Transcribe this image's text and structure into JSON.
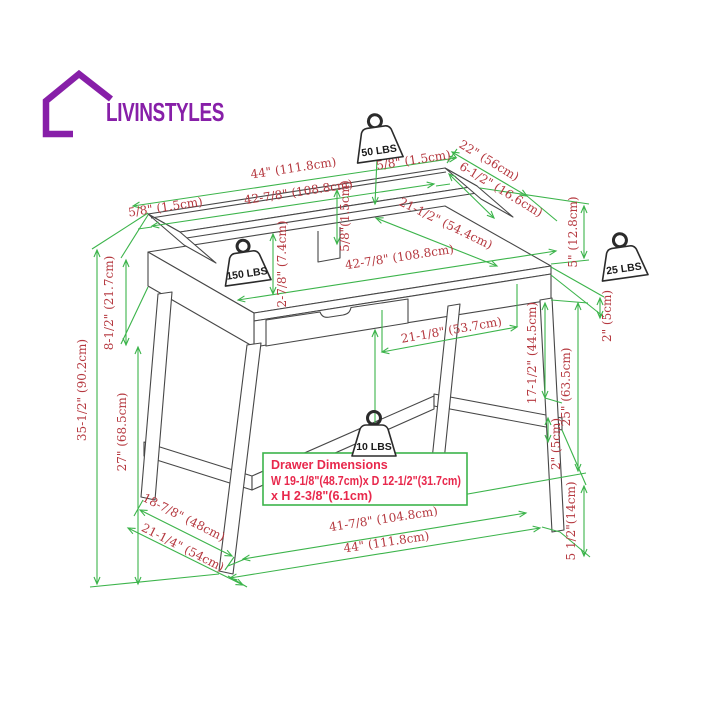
{
  "logo": {
    "brand": "LIVINSTYLES"
  },
  "weights": {
    "top": "50 LBS",
    "desktop": "150 LBS",
    "side": "25 LBS",
    "drawer": "10 LBS"
  },
  "dimensions": {
    "top_width": "44\" (111.8cm)",
    "top_width_inner": "42-7/8\" (108.8cm)",
    "top_offset_left": "5/8\" (1.5cm)",
    "top_offset_right": "5/8\" (1.5cm)",
    "depth": "22\" (56cm)",
    "shelf_depth": "6-1/2\" (16.6cm)",
    "desktop_depth": "21-1/2\" (54.4cm)",
    "riser_height": "5\" (12.8cm)",
    "shelf_thickness": "5/8\"(1.5cm)",
    "shelf_clearance": "2-7/8\" (7.4cm)",
    "desktop_width": "42-7/8\" (108.8cm)",
    "leg_inner_span": "21-1/8\" (53.7cm)",
    "carcass_height": "8-1/2\" (21.7cm)",
    "overall_height": "35-1/2\" (90.2cm)",
    "leg_height": "27\" (68.5cm)",
    "top_edge": "2\" (5cm)",
    "stretcher_drop": "17-1/2\" (44.5cm)",
    "underside_to_floor": "25\" (63.5cm)",
    "stretcher_thickness": "2\" (5cm)",
    "stretcher_to_floor": "5 1/2\"(14cm)",
    "foot_span_inner": "18-7/8\" (48cm)",
    "foot_span_outer": "21-1/4\" (54cm)",
    "bottom_width_inner": "41-7/8\" (104.8cm)",
    "bottom_width_outer": "44\" (111.8cm)"
  },
  "drawer_note": {
    "line1": "Drawer Dimensions",
    "line2": "W 19-1/8\"(48.7cm)x D 12-1/2\"(31.7cm)",
    "line3": "x H 2-3/8\"(6.1cm)"
  },
  "colors": {
    "dimension_line": "#3cb44b",
    "dimension_text": "#b5383f",
    "callout_text": "#e8284c",
    "drawing_line": "#474747",
    "brand": "#871fa8"
  }
}
